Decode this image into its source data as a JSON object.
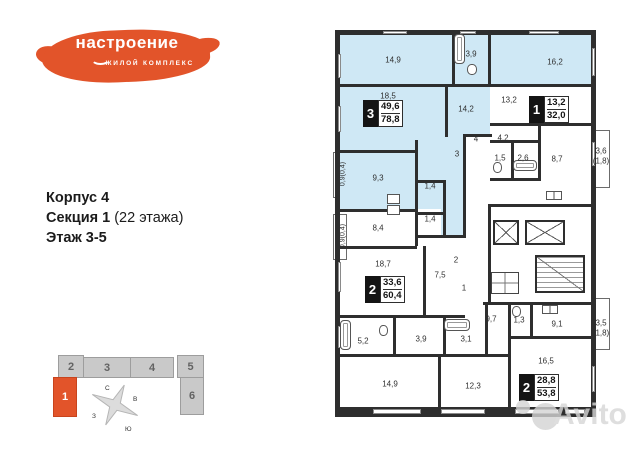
{
  "logo": {
    "title": "настроение",
    "subtitle": "ЖИЛОЙ КОМПЛЕКС"
  },
  "info": {
    "corpus": "Корпус 4",
    "section": "Секция 1",
    "section_note": " (22 этажа)",
    "floor": "Этаж 3-5"
  },
  "building": {
    "sections": [
      {
        "label": "2"
      },
      {
        "label": "3"
      },
      {
        "label": "4"
      },
      {
        "label": "5"
      },
      {
        "label": "1",
        "highlighted": true
      },
      {
        "label": "6"
      }
    ],
    "compass": {
      "n": "С",
      "e": "В",
      "s": "Ю",
      "w": "З"
    }
  },
  "floor_plan": {
    "apartments": [
      {
        "badge": "3",
        "area_living": "49,6",
        "area_total": "78,8",
        "highlighted": true
      },
      {
        "badge": "1",
        "area_living": "13,2",
        "area_total": "32,0",
        "highlighted": false
      },
      {
        "badge": "2",
        "area_living": "33,6",
        "area_total": "60,4",
        "highlighted": false
      },
      {
        "badge": "2",
        "area_living": "28,8",
        "area_total": "53,8",
        "highlighted": false
      }
    ],
    "labels": [
      {
        "n": "bedroom-top-left",
        "t": "14,9"
      },
      {
        "n": "bathroom-top",
        "t": "3,9"
      },
      {
        "n": "room-top-right",
        "t": "16,2"
      },
      {
        "n": "room-18-5",
        "t": "18,5"
      },
      {
        "n": "hall-14-2",
        "t": "14,2"
      },
      {
        "n": "room-13-2",
        "t": "13,2"
      },
      {
        "n": "corridor-3",
        "t": "3"
      },
      {
        "n": "hall-4",
        "t": "4"
      },
      {
        "n": "hall-4-2",
        "t": "4,2"
      },
      {
        "n": "wc-1-5",
        "t": "1,5"
      },
      {
        "n": "bath-2-6",
        "t": "2,6"
      },
      {
        "n": "kitchen-8-7",
        "t": "8,7"
      },
      {
        "n": "balcony-3-6",
        "t": "3,6"
      },
      {
        "n": "balcony-3-6-reduced",
        "t": "(1,8)"
      },
      {
        "n": "room-9-3",
        "t": "9,3"
      },
      {
        "n": "wc-1-4-a",
        "t": "1,4"
      },
      {
        "n": "wc-1-4-b",
        "t": "1,4"
      },
      {
        "n": "room-8-4",
        "t": "8,4"
      },
      {
        "n": "room-18-7",
        "t": "18,7"
      },
      {
        "n": "hall-7-5",
        "t": "7,5"
      },
      {
        "n": "corridor-2",
        "t": "2"
      },
      {
        "n": "corridor-1",
        "t": "1"
      },
      {
        "n": "room-9-7",
        "t": "9,7"
      },
      {
        "n": "wc-1-3",
        "t": "1,3"
      },
      {
        "n": "kitchen-9-1",
        "t": "9,1"
      },
      {
        "n": "bath-3-1",
        "t": "3,1"
      },
      {
        "n": "bath-5-2",
        "t": "5,2"
      },
      {
        "n": "hall-3-9",
        "t": "3,9"
      },
      {
        "n": "balcony-3-5",
        "t": "3,5"
      },
      {
        "n": "balcony-3-5-reduced",
        "t": "(1,8)"
      },
      {
        "n": "room-16-5",
        "t": "16,5"
      },
      {
        "n": "room-14-9-bottom",
        "t": "14,9"
      },
      {
        "n": "room-12-3",
        "t": "12,3"
      },
      {
        "n": "balcony-0-9-a",
        "t": "0,9(0,4)"
      },
      {
        "n": "balcony-0-9-b",
        "t": "0,9(0,4)"
      }
    ]
  },
  "watermark": {
    "text": "Avito"
  },
  "colors": {
    "accent_orange": "#e2542a",
    "apartment_highlight_blue": "#cfe8f5",
    "wall": "#2e2e2e",
    "section_gray": "#c9c9c9"
  }
}
